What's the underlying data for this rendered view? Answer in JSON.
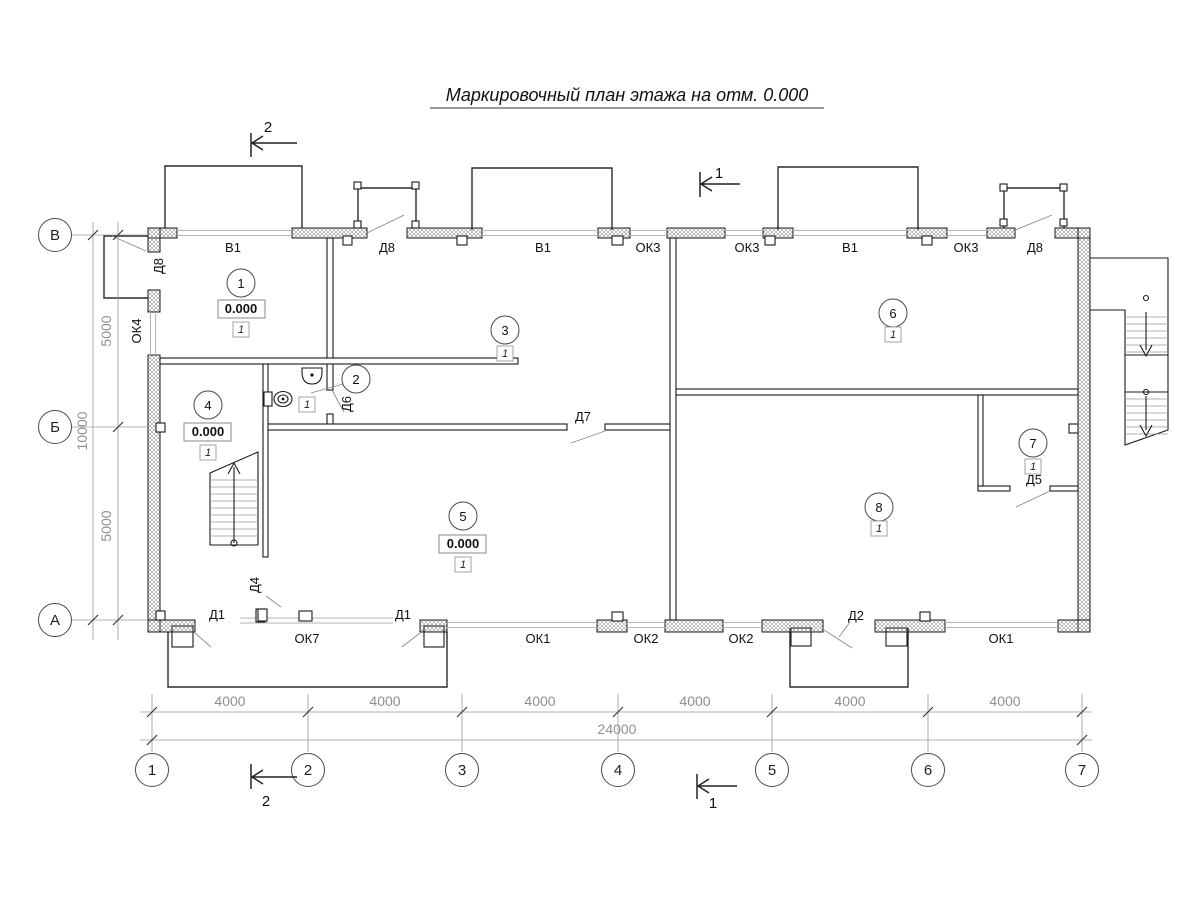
{
  "title": {
    "text": "Маркировочный план этажа на отм. 0.000"
  },
  "axes": {
    "cols": [
      "1",
      "2",
      "3",
      "4",
      "5",
      "6",
      "7"
    ],
    "rows": [
      "В",
      "Б",
      "А"
    ]
  },
  "dims": {
    "bottom": [
      "4000",
      "4000",
      "4000",
      "4000",
      "4000",
      "4000"
    ],
    "bottom_total": "24000",
    "left_top": "5000",
    "left_total": "10000",
    "left_bottom": "5000"
  },
  "sections": {
    "s1": "1",
    "s2": "2"
  },
  "rooms": [
    {
      "num": "1",
      "elev": "0.000",
      "fin": "1"
    },
    {
      "num": "2",
      "fin": "1"
    },
    {
      "num": "3",
      "fin": "1"
    },
    {
      "num": "4",
      "elev": "0.000",
      "fin": "1"
    },
    {
      "num": "5",
      "elev": "0.000",
      "fin": "1"
    },
    {
      "num": "6",
      "fin": "1"
    },
    {
      "num": "7",
      "fin": "1"
    },
    {
      "num": "8",
      "fin": "1"
    }
  ],
  "marks": {
    "top": [
      "В1",
      "Д8",
      "В1",
      "ОК3",
      "ОК3",
      "В1",
      "ОК3",
      "Д8"
    ],
    "bottom": [
      "Д1",
      "ОК7",
      "Д1",
      "ОК1",
      "ОК2",
      "ОК2",
      "Д2",
      "ОК1"
    ],
    "left": [
      "Д8",
      "ОК4"
    ],
    "inner": [
      "Д6",
      "Д7",
      "Д4",
      "Д5"
    ]
  }
}
